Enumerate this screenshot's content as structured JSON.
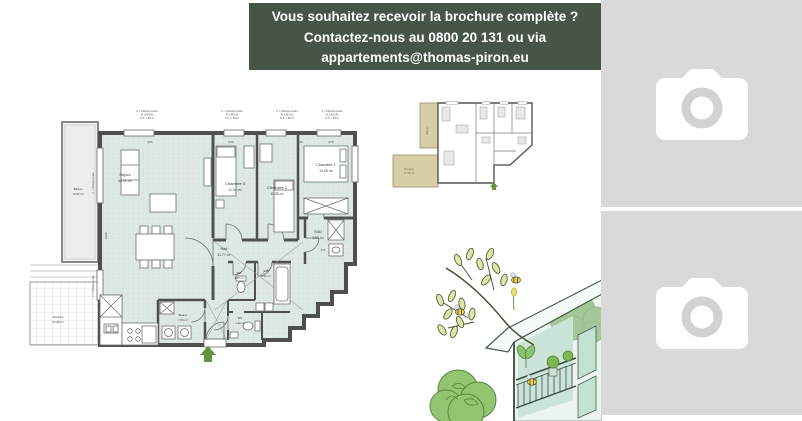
{
  "banner": {
    "line1": "Vous souhaitez recevoir la brochure complète ?",
    "line2": "Contactez-nous au 0800 20 131 ou via",
    "line3": "appartements@thomas-piron.eu"
  },
  "floorplan": {
    "rooms": [
      {
        "name": "Séjour",
        "area": "40.09 m²"
      },
      {
        "name": "Chambre 3",
        "area": "11.34 m²"
      },
      {
        "name": "Chambre 2",
        "area": "11.35 m²"
      },
      {
        "name": "Chambre 1",
        "area": "13.06 m²"
      },
      {
        "name": "SdD",
        "area": "3.53 m²"
      },
      {
        "name": "Hall",
        "area": "11.77 m²"
      },
      {
        "name": "WC",
        "area": "1.83 m²"
      },
      {
        "name": "SdB",
        "area": "4.51 m²"
      },
      {
        "name": "WC",
        "area": "1.42 m²"
      },
      {
        "name": "Buand.",
        "area": "7.64 m²"
      },
      {
        "name": "Balcon",
        "area": "13.03 m²"
      },
      {
        "name": "Terrasse",
        "area": "37.08 m²"
      }
    ],
    "window_note_l1": "C = Châssis isolant",
    "window_note_l2": "B. 140/235",
    "window_note_l3": "H.A. = 85cm",
    "dims": {
      "d1": "445",
      "d2": "230",
      "d3": "236",
      "d4": "278",
      "d5": "1008",
      "d6": "171"
    }
  },
  "thumbnail": {
    "balcony_label": "Balcon",
    "terrace_label": "Terrasse",
    "terrace_area": "37.08 m²"
  },
  "colors": {
    "banner_bg": "#475548",
    "banner_text": "#ffffff",
    "plan_fill": "#dfe9e3",
    "plan_wall": "#4f4f4f",
    "outdoor_beige": "#d6cea5",
    "placeholder_bg": "#d9d9d9",
    "placeholder_icon": "#ffffff",
    "entrance_arrow": "#63913c"
  }
}
